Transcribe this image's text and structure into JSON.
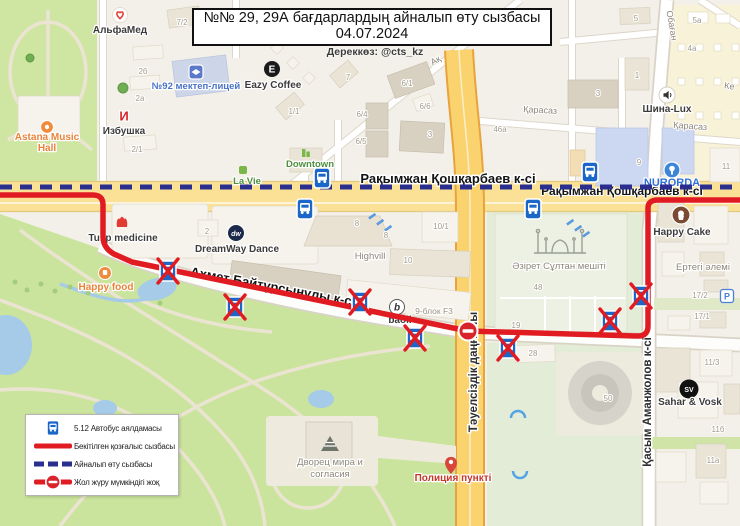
{
  "header": {
    "title_line1": "№№ 29, 29А бағдарлардың айналып өту сызбасы",
    "title_line2": "04.07.2024",
    "source": "Дереккөз: @cts_kz"
  },
  "legend": {
    "items": [
      {
        "icon": "bus-stop-sign",
        "label": "5.12 Автобус аялдамасы"
      },
      {
        "icon": "red-solid-line",
        "label": "Бекітілген қозғалыс сызбасы"
      },
      {
        "icon": "blue-dashed-line",
        "label": "Айналып өту сызбасы"
      },
      {
        "icon": "no-entry-on-line",
        "label": "Жол жүру мүмкіндігі жоқ"
      }
    ]
  },
  "colors": {
    "approved_route": "#e01b22",
    "detour_route": "#2a2e8f",
    "bus_stop_blue": "#1b66c9"
  },
  "map": {
    "icon_letters": {
      "eazy": "E",
      "izbushka": "И",
      "dreamway": "dw",
      "sahar": "SV",
      "baoli": "b",
      "parking": "P"
    },
    "numbers": [
      {
        "t": "7/2",
        "x": 182,
        "y": 25
      },
      {
        "t": "2б",
        "x": 143,
        "y": 74
      },
      {
        "t": "2а",
        "x": 140,
        "y": 101
      },
      {
        "t": "2/1",
        "x": 137,
        "y": 152
      },
      {
        "t": "1/1",
        "x": 294,
        "y": 114
      },
      {
        "t": "7",
        "x": 348,
        "y": 80
      },
      {
        "t": "6/1",
        "x": 407,
        "y": 86
      },
      {
        "t": "6/6",
        "x": 425,
        "y": 109
      },
      {
        "t": "6/4",
        "x": 362,
        "y": 117
      },
      {
        "t": "6/5",
        "x": 361,
        "y": 144
      },
      {
        "t": "3",
        "x": 430,
        "y": 137
      },
      {
        "t": "2",
        "x": 207,
        "y": 234
      },
      {
        "t": "8",
        "x": 357,
        "y": 226
      },
      {
        "t": "8",
        "x": 386,
        "y": 238
      },
      {
        "t": "10",
        "x": 408,
        "y": 263
      },
      {
        "t": "10/1",
        "x": 441,
        "y": 229
      },
      {
        "t": "48",
        "x": 538,
        "y": 290
      },
      {
        "t": "3",
        "x": 598,
        "y": 96
      },
      {
        "t": "1",
        "x": 637,
        "y": 78
      },
      {
        "t": "5",
        "x": 636,
        "y": 21
      },
      {
        "t": "5а",
        "x": 697,
        "y": 23
      },
      {
        "t": "4а",
        "x": 692,
        "y": 51
      },
      {
        "t": "46а",
        "x": 500,
        "y": 132
      },
      {
        "t": "9",
        "x": 639,
        "y": 165
      },
      {
        "t": "11",
        "x": 726,
        "y": 169
      },
      {
        "t": "17/2",
        "x": 700,
        "y": 298
      },
      {
        "t": "17/1",
        "x": 702,
        "y": 319
      },
      {
        "t": "19",
        "x": 516,
        "y": 328
      },
      {
        "t": "28",
        "x": 533,
        "y": 356
      },
      {
        "t": "50",
        "x": 608,
        "y": 401
      },
      {
        "t": "11/3",
        "x": 712,
        "y": 365
      },
      {
        "t": "11б",
        "x": 718,
        "y": 432
      },
      {
        "t": "11а",
        "x": 713,
        "y": 463
      }
    ],
    "labels": [
      {
        "t": "Рақымжан Қошқарбаев к-сі",
        "x": 448,
        "y": 183,
        "cls": "street",
        "n": "street-label-koshkarbaev"
      },
      {
        "t": "Рақымжан Қошқарбаев к-сі",
        "x": 622,
        "y": 195,
        "cls": "street2",
        "n": "street-label-koshkarbaev-2"
      },
      {
        "t": "Ахмет Байтұрсынұлы к-сі",
        "x": 272,
        "y": 291,
        "cls": "street",
        "rot": 10.5,
        "n": "street-label-baitursynuly"
      },
      {
        "t": "Тәуелсіздік даңғылы",
        "x": 477,
        "y": 372,
        "cls": "street-v",
        "rot": -90,
        "n": "street-label-tauelsizdik"
      },
      {
        "t": "Қасым Аманжолов к-сі",
        "x": 651,
        "y": 402,
        "cls": "street-v",
        "rot": -90,
        "n": "street-label-amanzholov"
      },
      {
        "t": "Қарасаз",
        "x": 540,
        "y": 113,
        "cls": "minor",
        "rot": 3,
        "n": "street-label-karasaz"
      },
      {
        "t": "Қарасаз",
        "x": 690,
        "y": 129,
        "cls": "minor",
        "rot": 4,
        "n": "street-label-karasaz-2"
      },
      {
        "t": "Обаған",
        "x": 669,
        "y": 26,
        "cls": "minor",
        "rot": 80,
        "n": "street-label-obagan"
      },
      {
        "t": "Ақ",
        "x": 437,
        "y": 63,
        "cls": "minor",
        "rot": -30,
        "n": "street-label-partial"
      },
      {
        "t": "Ке",
        "x": 729,
        "y": 89,
        "cls": "minor",
        "rot": 8,
        "n": "street-label-partial-2"
      },
      {
        "t": "АльфаМед",
        "x": 120,
        "y": 33,
        "cls": "poi",
        "n": "poi-label-alfamed"
      },
      {
        "t": "№92 мектеп-лицей",
        "x": 196,
        "y": 89,
        "cls": "poi-blue",
        "n": "poi-label-school92"
      },
      {
        "t": "Eazy Coffee",
        "x": 273,
        "y": 88,
        "cls": "poi",
        "n": "poi-label-eazy-coffee"
      },
      {
        "t": "Избушка",
        "x": 124,
        "y": 134,
        "cls": "poi",
        "n": "poi-label-izbushka"
      },
      {
        "t": "Astana Music",
        "x": 47,
        "y": 140,
        "cls": "poi-orange",
        "n": "poi-label-astana-music-hall"
      },
      {
        "t": "Hall",
        "x": 47,
        "y": 151,
        "cls": "poi-orange",
        "n": "poi-label-astana-music-hall-2"
      },
      {
        "t": "La Vie",
        "x": 247,
        "y": 184,
        "cls": "poi-green",
        "n": "poi-label-la-vie"
      },
      {
        "t": "Downtown",
        "x": 310,
        "y": 167,
        "cls": "poi-green",
        "n": "poi-label-downtown"
      },
      {
        "t": "NURORDA",
        "x": 672,
        "y": 186,
        "cls": "poi-blue-b",
        "n": "poi-label-nurorda"
      },
      {
        "t": "Шина-Lux",
        "x": 667,
        "y": 112,
        "cls": "poi",
        "n": "poi-label-shina-lux"
      },
      {
        "t": "Tulip medicine",
        "x": 123,
        "y": 241,
        "cls": "poi",
        "n": "poi-label-tulip-medicine"
      },
      {
        "t": "DreamWay Dance",
        "x": 237,
        "y": 252,
        "cls": "poi",
        "n": "poi-label-dreamway-dance"
      },
      {
        "t": "Happy food",
        "x": 106,
        "y": 290,
        "cls": "poi-orange",
        "n": "poi-label-happy-food"
      },
      {
        "t": "Highvill",
        "x": 370,
        "y": 259,
        "cls": "poi-gray",
        "n": "poi-label-highvill"
      },
      {
        "t": "Әзірет Сұлтан мешіті",
        "x": 559,
        "y": 269,
        "cls": "poi-gray",
        "n": "poi-label-mosque"
      },
      {
        "t": "Happy Cake",
        "x": 682,
        "y": 235,
        "cls": "poi",
        "n": "poi-label-happy-cake"
      },
      {
        "t": "Ертегі әлемі",
        "x": 703,
        "y": 270,
        "cls": "poi-gray",
        "n": "poi-label-ertegi-alemi"
      },
      {
        "t": "Sahar & Vosk",
        "x": 690,
        "y": 405,
        "cls": "poi",
        "n": "poi-label-sahar-vosk"
      },
      {
        "t": "Дворец мира и",
        "x": 330,
        "y": 465,
        "cls": "poi-gray",
        "n": "poi-label-palace-of-peace"
      },
      {
        "t": "согласия",
        "x": 330,
        "y": 477,
        "cls": "poi-gray",
        "n": "poi-label-palace-of-peace-2"
      },
      {
        "t": "Полиция пункті",
        "x": 453,
        "y": 481,
        "cls": "poi-red",
        "n": "poi-label-police-point"
      },
      {
        "t": "baoli",
        "x": 400,
        "y": 323,
        "cls": "poi",
        "n": "poi-label-baoli"
      },
      {
        "t": "9-блок F3",
        "x": 434,
        "y": 314,
        "cls": "poi-gray-sm",
        "n": "poi-label-block9-f3"
      }
    ]
  }
}
